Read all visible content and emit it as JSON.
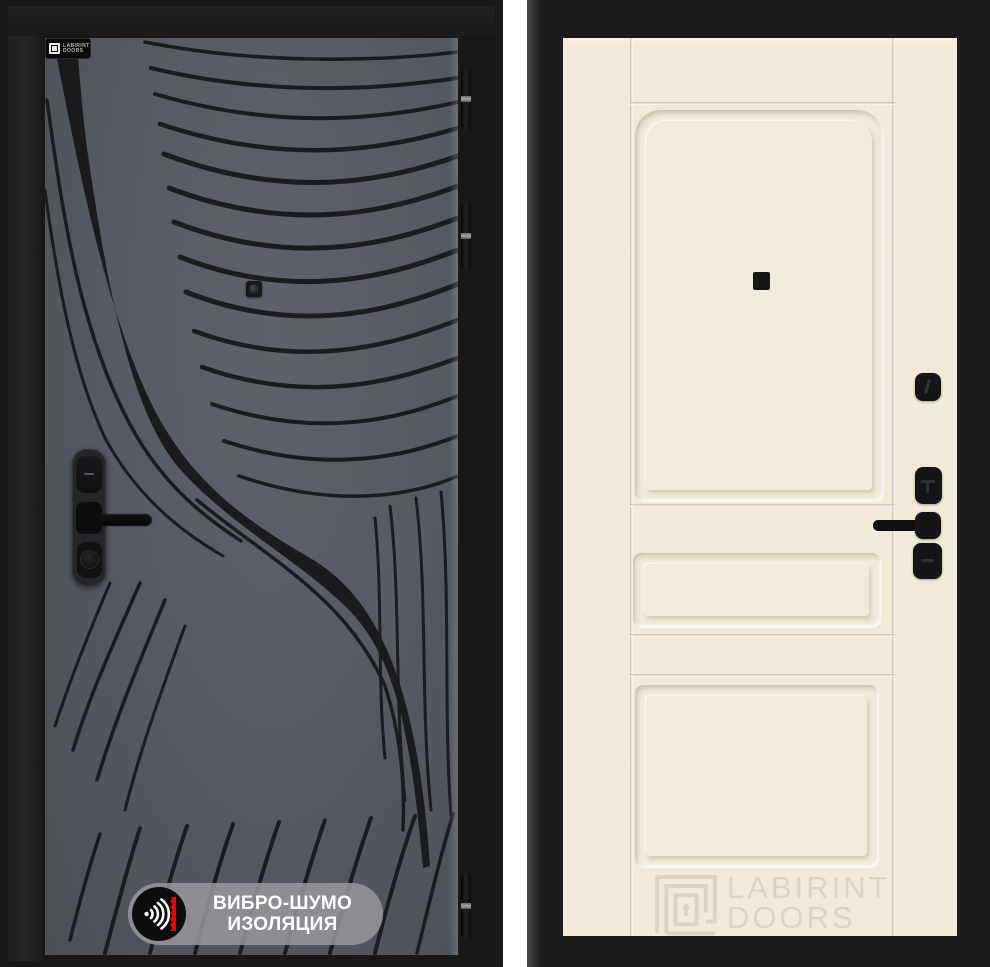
{
  "page": {
    "background": "#ffffff"
  },
  "left_door": {
    "label": "exterior-side-with-vortex-pattern",
    "frame_color": "#191816",
    "panel_color": "#565a62",
    "pattern_color": "#1c1c1f",
    "brand_plaque": {
      "line1": "LABIRINT",
      "line2": "DOORS"
    },
    "badge": {
      "line1": "ВИБРО-ШУМО",
      "line2": "ИЗОЛЯЦИЯ",
      "pill_color": "#96989c",
      "circle_color": "#0d0d0d",
      "wave_color": "#ffffff",
      "bar_color": "#e8000d",
      "text_color": "#ffffff"
    },
    "hinge_count": 3
  },
  "right_door": {
    "label": "interior-side-classic-panels",
    "frame_color": "#1d1c1b",
    "panel_color": "#f1ead8",
    "hardware_color": "#151517",
    "panel_count": 3,
    "watermark": {
      "line1": "LABIRINT",
      "line2": "DOORS",
      "color": "#dbd4c2"
    }
  }
}
